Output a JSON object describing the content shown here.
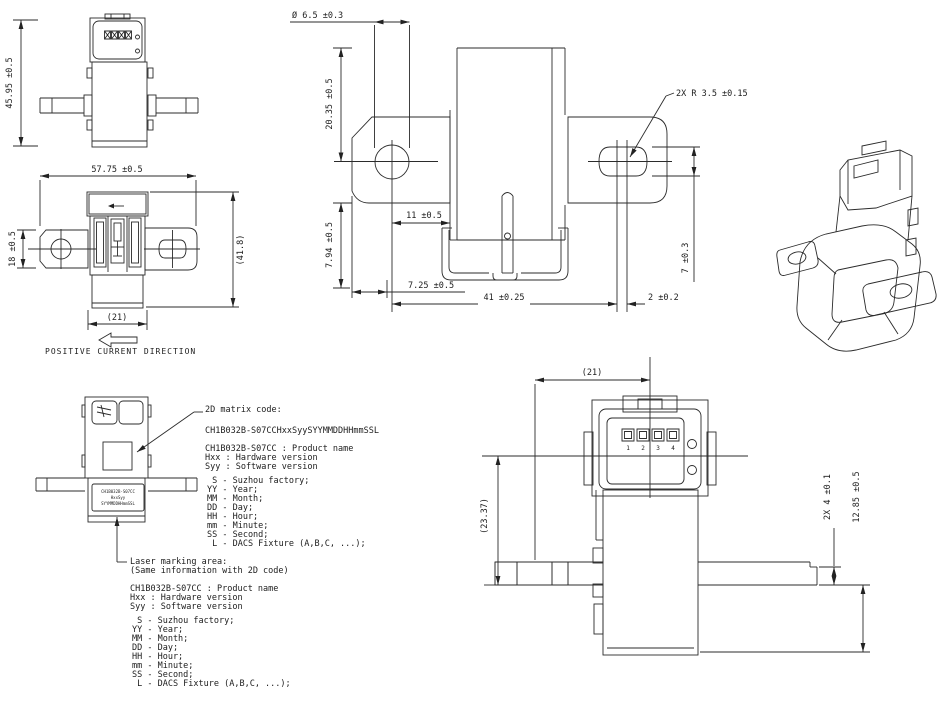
{
  "views": {
    "top_view": {
      "dim_height": "45.95 ±0.5"
    },
    "front_view": {
      "dim_width": "57.75 ±0.5",
      "dim_ref_height": "(41.8)",
      "dim_tab_height": "18 ±0.5",
      "dim_body_width": "(21)",
      "current_label": "POSITIVE CURRENT DIRECTION"
    },
    "bottom_view": {
      "dim_hole_dia": "Ø 6.5 ±0.3",
      "dim_tab_h": "20.35 ±0.5",
      "dim_radius": "2X R 3.5 ±0.15",
      "dim_11": "11 ±0.5",
      "dim_794": "7.94 ±0.5",
      "dim_725": "7.25 ±0.5",
      "dim_41": "41 ±0.25",
      "dim_7": "7 ±0.3",
      "dim_2": "2 ±0.2"
    },
    "side_view": {
      "dim_21": "(21)",
      "dim_2337": "(23.37)",
      "dim_2x4": "2X 4 ±0.1",
      "dim_1285": "12.85 ±0.5",
      "pins": [
        "1",
        "2",
        "3",
        "4"
      ]
    }
  },
  "annotations": {
    "matrix_code": {
      "title": "2D matrix code:",
      "code_string": "CH1B032B-S07CCHxxSyySYYMMDDHHmmSSL",
      "product": "CH1B032B-S07CC : Product name",
      "hardware": "Hxx : Hardware version",
      "software": "Syy : Software version",
      "legend": [
        " S - Suzhou factory;",
        "YY - Year;",
        "MM - Month;",
        "DD - Day;",
        "HH - Hour;",
        "mm - Minute;",
        "SS - Second;",
        " L - DACS Fixture (A,B,C, ...);"
      ]
    },
    "laser_marking": {
      "title": "Laser marking area:",
      "subtitle": "(Same information with 2D code)",
      "product": "CH1B032B-S07CC : Product name",
      "hardware": "Hxx : Hardware version",
      "software": "Syy : Software version",
      "marking_lines": [
        "CH1B032B-S07CC",
        "HxxSyy",
        "SYYMMDDHHmmSSL"
      ],
      "legend": [
        " S - Suzhou factory;",
        "YY - Year;",
        "MM - Month;",
        "DD - Day;",
        "HH - Hour;",
        "mm - Minute;",
        "SS - Second;",
        " L - DACS Fixture (A,B,C, ...);"
      ]
    }
  }
}
